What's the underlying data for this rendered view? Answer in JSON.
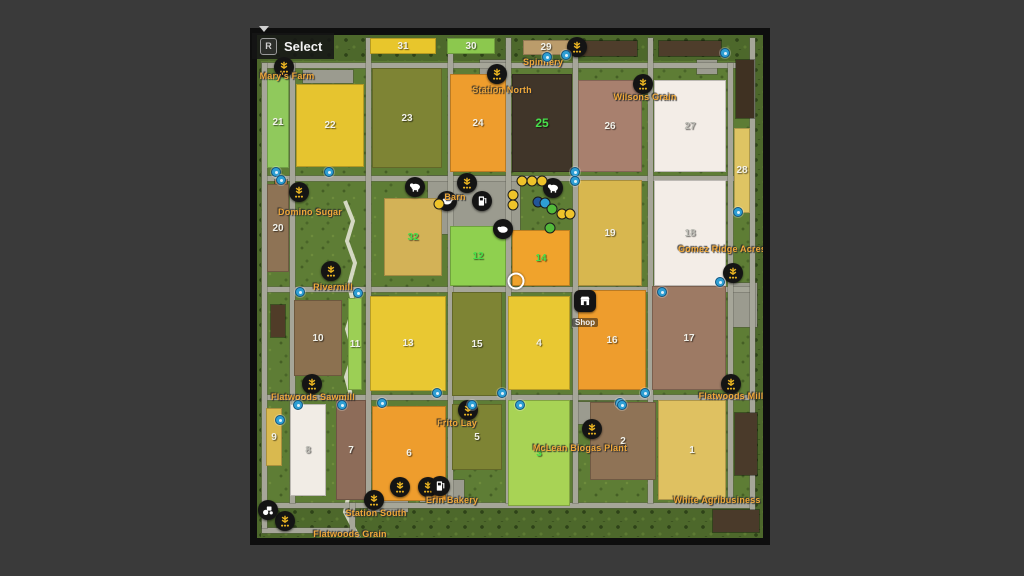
{
  "hud": {
    "select_key": "R",
    "select_label": "Select"
  },
  "map": {
    "colors": {
      "grass": "#5e7d35",
      "border_grass": "#4d682b",
      "road": "#a6a699",
      "pad": "#9b9b8f",
      "label": "#f0a83a",
      "owned_number": "#46e04a",
      "number": "#f2f2ea",
      "faint_number": "#bdbdb6",
      "river": "#e9e7db",
      "marker_blue": "#2e9fd4",
      "dot_yellow": "#eec32a",
      "dot_blue": "#2e9fd4",
      "dot_navy": "#22559a",
      "dot_green": "#52b93a"
    },
    "bands": [
      {
        "x": 0,
        "y": 0,
        "w": 506,
        "h": 26
      },
      {
        "x": 0,
        "y": 472,
        "w": 506,
        "h": 31
      },
      {
        "x": 0,
        "y": 0,
        "w": 4,
        "h": 503
      },
      {
        "x": 495,
        "y": 0,
        "w": 11,
        "h": 503
      }
    ],
    "river_points": "88,166 96,186 90,206 98,228 92,250 97,272 90,294 97,318 89,342 95,364 88,388 93,412 86,436 92,458 88,477 96,492 102,503",
    "roads_h": [
      {
        "x": 5,
        "y": 28,
        "w": 478
      },
      {
        "x": 5,
        "y": 141,
        "w": 490
      },
      {
        "x": 5,
        "y": 252,
        "w": 490
      },
      {
        "x": 5,
        "y": 360,
        "w": 490
      },
      {
        "x": 5,
        "y": 468,
        "w": 490
      },
      {
        "x": 5,
        "y": 493,
        "w": 90
      }
    ],
    "roads_v": [
      {
        "x": 5,
        "y": 28,
        "h": 465
      },
      {
        "x": 33,
        "y": 28,
        "h": 440
      },
      {
        "x": 109,
        "y": 3,
        "h": 465
      },
      {
        "x": 191,
        "y": 3,
        "h": 465
      },
      {
        "x": 249,
        "y": 3,
        "h": 465
      },
      {
        "x": 316,
        "y": 3,
        "h": 465
      },
      {
        "x": 391,
        "y": 3,
        "h": 465
      },
      {
        "x": 471,
        "y": 28,
        "h": 440
      },
      {
        "x": 493,
        "y": 3,
        "h": 490
      },
      {
        "x": 93,
        "y": 468,
        "h": 32
      }
    ],
    "pads": [
      {
        "x": 46,
        "y": 35,
        "w": 50,
        "h": 13
      },
      {
        "x": 223,
        "y": 25,
        "w": 30,
        "h": 14
      },
      {
        "x": 440,
        "y": 25,
        "w": 20,
        "h": 14
      },
      {
        "x": 171,
        "y": 141,
        "w": 92,
        "h": 58
      },
      {
        "x": 111,
        "y": 261,
        "w": 20,
        "h": 12
      },
      {
        "x": 195,
        "y": 259,
        "w": 44,
        "h": 14
      },
      {
        "x": 315,
        "y": 257,
        "w": 36,
        "h": 36
      },
      {
        "x": 476,
        "y": 248,
        "w": 24,
        "h": 44
      },
      {
        "x": 321,
        "y": 367,
        "w": 36,
        "h": 22
      },
      {
        "x": 163,
        "y": 445,
        "w": 44,
        "h": 22
      },
      {
        "x": 111,
        "y": 457,
        "w": 40,
        "h": 20
      }
    ],
    "dark_rects": [
      {
        "x": 318,
        "y": 6,
        "w": 62,
        "h": 15,
        "c": "#4e3d2b"
      },
      {
        "x": 402,
        "y": 6,
        "w": 62,
        "h": 15,
        "c": "#4e3d2b"
      },
      {
        "x": 479,
        "y": 25,
        "w": 18,
        "h": 58,
        "c": "#3f3122"
      },
      {
        "x": 478,
        "y": 378,
        "w": 22,
        "h": 62,
        "c": "#4a3a2a"
      },
      {
        "x": 456,
        "y": 475,
        "w": 46,
        "h": 22,
        "c": "#4a3a2a"
      },
      {
        "x": 14,
        "y": 270,
        "w": 14,
        "h": 32,
        "c": "#503c28"
      },
      {
        "x": 18,
        "y": 145,
        "w": 12,
        "h": 9,
        "c": "#9a5f2c"
      }
    ],
    "fields": [
      {
        "n": "31",
        "x": 113,
        "y": 3,
        "w": 66,
        "h": 16,
        "c": "#e8c62c",
        "t": "w"
      },
      {
        "n": "30",
        "x": 190,
        "y": 3,
        "w": 48,
        "h": 16,
        "c": "#8cc84e",
        "t": "w"
      },
      {
        "n": "29",
        "x": 266,
        "y": 5,
        "w": 46,
        "h": 15,
        "c": "#bb9c6b",
        "t": "w"
      },
      {
        "n": "21",
        "x": 10,
        "y": 41,
        "w": 22,
        "h": 92,
        "c": "#90c95c",
        "t": "w"
      },
      {
        "n": "22",
        "x": 39,
        "y": 49,
        "w": 68,
        "h": 83,
        "c": "#e6c42f",
        "t": "w"
      },
      {
        "n": "23",
        "x": 115,
        "y": 33,
        "w": 70,
        "h": 100,
        "c": "#7e8434",
        "t": "w"
      },
      {
        "n": "24",
        "x": 193,
        "y": 39,
        "w": 56,
        "h": 98,
        "c": "#ee9d2d",
        "t": "w"
      },
      {
        "n": "25",
        "x": 255,
        "y": 39,
        "w": 60,
        "h": 98,
        "c": "#403529",
        "t": "g",
        "big": true
      },
      {
        "n": "26",
        "x": 321,
        "y": 45,
        "w": 64,
        "h": 92,
        "c": "#a8806e",
        "t": "w"
      },
      {
        "n": "27",
        "x": 397,
        "y": 45,
        "w": 72,
        "h": 92,
        "c": "#f3ede7",
        "t": "f"
      },
      {
        "n": "28",
        "x": 477,
        "y": 93,
        "w": 16,
        "h": 85,
        "c": "#dec463",
        "t": "w"
      },
      {
        "n": "20",
        "x": 10,
        "y": 149,
        "w": 22,
        "h": 88,
        "c": "#8e7355",
        "t": "w"
      },
      {
        "n": "32",
        "x": 127,
        "y": 163,
        "w": 58,
        "h": 78,
        "c": "#d3b257",
        "t": "g"
      },
      {
        "n": "12",
        "x": 193,
        "y": 191,
        "w": 56,
        "h": 60,
        "c": "#8fd04f",
        "t": "g"
      },
      {
        "n": "14",
        "x": 255,
        "y": 195,
        "w": 58,
        "h": 56,
        "c": "#f0a32c",
        "t": "g"
      },
      {
        "n": "19",
        "x": 321,
        "y": 145,
        "w": 64,
        "h": 106,
        "c": "#d8b74f",
        "t": "w"
      },
      {
        "n": "18",
        "x": 397,
        "y": 145,
        "w": 72,
        "h": 106,
        "c": "#f3ede7",
        "t": "f"
      },
      {
        "n": "10",
        "x": 37,
        "y": 265,
        "w": 48,
        "h": 76,
        "c": "#8c7150",
        "t": "w"
      },
      {
        "n": "11",
        "x": 91,
        "y": 263,
        "w": 14,
        "h": 92,
        "c": "#9ccf55",
        "t": "w"
      },
      {
        "n": "13",
        "x": 113,
        "y": 261,
        "w": 76,
        "h": 95,
        "c": "#e9c832",
        "t": "w"
      },
      {
        "n": "15",
        "x": 195,
        "y": 257,
        "w": 50,
        "h": 104,
        "c": "#7e8434",
        "t": "w"
      },
      {
        "n": "4",
        "x": 251,
        "y": 261,
        "w": 62,
        "h": 94,
        "c": "#e9c832",
        "t": "w"
      },
      {
        "n": "16",
        "x": 321,
        "y": 255,
        "w": 68,
        "h": 100,
        "c": "#ee9d2d",
        "t": "w"
      },
      {
        "n": "17",
        "x": 395,
        "y": 251,
        "w": 74,
        "h": 104,
        "c": "#9d7a64",
        "t": "w"
      },
      {
        "n": "9",
        "x": 9,
        "y": 373,
        "w": 16,
        "h": 58,
        "c": "#d9b94f",
        "t": "w"
      },
      {
        "n": "8",
        "x": 33,
        "y": 369,
        "w": 36,
        "h": 92,
        "c": "#f1ece5",
        "t": "f"
      },
      {
        "n": "7",
        "x": 79,
        "y": 365,
        "w": 30,
        "h": 100,
        "c": "#8d6c59",
        "t": "w"
      },
      {
        "n": "6",
        "x": 115,
        "y": 371,
        "w": 74,
        "h": 95,
        "c": "#ee9d2d",
        "t": "w"
      },
      {
        "n": "5",
        "x": 195,
        "y": 369,
        "w": 50,
        "h": 66,
        "c": "#7e8434",
        "t": "w"
      },
      {
        "n": "3",
        "x": 251,
        "y": 365,
        "w": 62,
        "h": 106,
        "c": "#a8d355",
        "t": "g"
      },
      {
        "n": "2",
        "x": 333,
        "y": 367,
        "w": 66,
        "h": 78,
        "c": "#8f7356",
        "t": "w"
      },
      {
        "n": "1",
        "x": 401,
        "y": 365,
        "w": 68,
        "h": 100,
        "c": "#dfc161",
        "t": "w"
      }
    ],
    "labels": [
      {
        "t": "Mary's Farm",
        "x": 30,
        "y": 41
      },
      {
        "t": "Spinnery",
        "x": 286,
        "y": 27
      },
      {
        "t": "Station North",
        "x": 245,
        "y": 55
      },
      {
        "t": "Wilsons Grain",
        "x": 388,
        "y": 62
      },
      {
        "t": "Domino Sugar",
        "x": 53,
        "y": 177
      },
      {
        "t": "Barn",
        "x": 198,
        "y": 162
      },
      {
        "t": "Gomez Ridge Acres",
        "x": 465,
        "y": 214
      },
      {
        "t": "Rivermill",
        "x": 76,
        "y": 252
      },
      {
        "t": "Flatwoods Sawmill",
        "x": 56,
        "y": 362
      },
      {
        "t": "Flatwoods Mill",
        "x": 474,
        "y": 361
      },
      {
        "t": "Frito Lay",
        "x": 200,
        "y": 388
      },
      {
        "t": "McLean Biogas Plant",
        "x": 323,
        "y": 413
      },
      {
        "t": "Erin Bakery",
        "x": 195,
        "y": 465
      },
      {
        "t": "Station South",
        "x": 119,
        "y": 478
      },
      {
        "t": "White Agribusiness",
        "x": 460,
        "y": 465
      },
      {
        "t": "Flatwoods Grain",
        "x": 93,
        "y": 499
      }
    ],
    "sell_points": [
      {
        "name": "marys-farm",
        "x": 27,
        "y": 32
      },
      {
        "name": "spinnery",
        "x": 320,
        "y": 12
      },
      {
        "name": "station-north",
        "x": 240,
        "y": 39
      },
      {
        "name": "wilsons-grain",
        "x": 386,
        "y": 49
      },
      {
        "name": "domino-sugar",
        "x": 42,
        "y": 157
      },
      {
        "name": "barn",
        "x": 210,
        "y": 148
      },
      {
        "name": "rivermill",
        "x": 74,
        "y": 236
      },
      {
        "name": "gomez-ridge-acres",
        "x": 476,
        "y": 238
      },
      {
        "name": "flatwoods-sawmill",
        "x": 55,
        "y": 349
      },
      {
        "name": "flatwoods-mill",
        "x": 474,
        "y": 349
      },
      {
        "name": "frito-lay",
        "x": 211,
        "y": 375
      },
      {
        "name": "mclean-biogas",
        "x": 335,
        "y": 394
      },
      {
        "name": "erin-bakery-1",
        "x": 143,
        "y": 452
      },
      {
        "name": "erin-bakery-2",
        "x": 171,
        "y": 452
      },
      {
        "name": "station-south",
        "x": 117,
        "y": 465
      },
      {
        "name": "flatwoods-grain",
        "x": 28,
        "y": 486
      }
    ],
    "pois": [
      {
        "type": "cow",
        "x": 158,
        "y": 152
      },
      {
        "type": "sheep",
        "x": 190,
        "y": 166
      },
      {
        "type": "pig",
        "x": 246,
        "y": 194
      },
      {
        "type": "cow",
        "x": 296,
        "y": 153
      },
      {
        "type": "fuel",
        "x": 225,
        "y": 166
      },
      {
        "type": "fuel",
        "x": 183,
        "y": 451
      },
      {
        "type": "tractor",
        "x": 11,
        "y": 475
      }
    ],
    "shop": {
      "label": "Shop",
      "x": 328,
      "y": 255
    },
    "dots": [
      {
        "c": "y",
        "x": 265,
        "y": 146
      },
      {
        "c": "y",
        "x": 275,
        "y": 146
      },
      {
        "c": "y",
        "x": 285,
        "y": 146
      },
      {
        "c": "y",
        "x": 256,
        "y": 160
      },
      {
        "c": "y",
        "x": 256,
        "y": 170
      },
      {
        "c": "y",
        "x": 305,
        "y": 179
      },
      {
        "c": "y",
        "x": 313,
        "y": 179
      },
      {
        "c": "y",
        "x": 182,
        "y": 169
      },
      {
        "c": "n",
        "x": 281,
        "y": 167
      },
      {
        "c": "b",
        "x": 288,
        "y": 168
      },
      {
        "c": "g",
        "x": 295,
        "y": 174
      },
      {
        "c": "g",
        "x": 293,
        "y": 193
      }
    ],
    "markers": [
      {
        "x": 19,
        "y": 137
      },
      {
        "x": 24,
        "y": 145
      },
      {
        "x": 72,
        "y": 137
      },
      {
        "x": 290,
        "y": 22
      },
      {
        "x": 309,
        "y": 20
      },
      {
        "x": 468,
        "y": 18
      },
      {
        "x": 318,
        "y": 137
      },
      {
        "x": 318,
        "y": 146
      },
      {
        "x": 481,
        "y": 177
      },
      {
        "x": 463,
        "y": 247
      },
      {
        "x": 405,
        "y": 257
      },
      {
        "x": 43,
        "y": 257
      },
      {
        "x": 101,
        "y": 258
      },
      {
        "x": 125,
        "y": 368
      },
      {
        "x": 180,
        "y": 358
      },
      {
        "x": 245,
        "y": 358
      },
      {
        "x": 363,
        "y": 368
      },
      {
        "x": 388,
        "y": 358
      },
      {
        "x": 41,
        "y": 370
      },
      {
        "x": 85,
        "y": 370
      },
      {
        "x": 215,
        "y": 370
      },
      {
        "x": 263,
        "y": 370
      },
      {
        "x": 365,
        "y": 370
      },
      {
        "x": 23,
        "y": 385
      }
    ],
    "player": {
      "x": 259,
      "y": 246
    }
  }
}
